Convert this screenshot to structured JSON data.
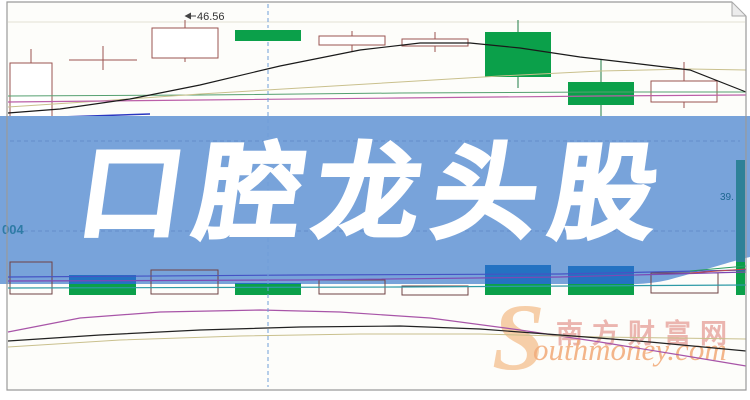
{
  "banner": {
    "title": "口腔龙头股"
  },
  "watermark": {
    "s": "S",
    "en_rest": "outhmoney.com",
    "cn": "南方财富网"
  },
  "colors": {
    "banner": "#78a3da",
    "candle_green": "#0ba04a",
    "candle_outline": "#9a5450",
    "green_wick": "#1f7d45",
    "vol_outline": "#6f4244",
    "cap_blue": "#2472c2",
    "ma_black": "#1a1a1a",
    "ma_khaki": "#c9c08d",
    "ma_green": "#55a070",
    "ma_magenta": "#bb5fa8",
    "ma_blue": "#2a36c0",
    "vol_blue": "#4553c4",
    "vol_purple": "#7d49b4",
    "vol_teal": "#2e9aa6",
    "seg_red": "#c44848",
    "seg_green": "#2a9e62",
    "low_magenta": "#a855a8",
    "low_black": "#222222",
    "low_khaki": "#c9c08d",
    "crosshair": "#6f9ed8",
    "grid_banner": "rgba(60,95,165,0.32)",
    "grid_top": "#e4e1d4",
    "price_label_color": "#333333",
    "left_label_color": "#2e7ba6",
    "right_label_color": "#1e6690"
  },
  "chart_data": {
    "type": "candlestick",
    "units": "pixels",
    "description": "Daily K-line chart with volume pane and indicator curves, overlaid by a blue headline banner; only one price value (46.56) is visible on screen.",
    "price_label": "46.56",
    "left_label": "004",
    "right_label": "39.",
    "crosshair": {
      "x": 268,
      "segments": [
        [
          4,
          28
        ],
        [
          42,
          387
        ]
      ]
    },
    "grid": {
      "top_y": 22,
      "banner_y": [
        141,
        231
      ]
    },
    "candles": [
      {
        "x": 10,
        "w": 42,
        "type": "hollow",
        "body": [
          63,
          127
        ],
        "wick": [
          49,
          133
        ]
      },
      {
        "x": 69,
        "w": 68,
        "type": "doji",
        "body": [
          60,
          60
        ],
        "wick": [
          46,
          70
        ]
      },
      {
        "x": 152,
        "w": 66,
        "type": "hollow",
        "body": [
          28,
          58
        ],
        "wick": [
          20,
          62
        ]
      },
      {
        "x": 235,
        "w": 66,
        "type": "green",
        "body": [
          30,
          41
        ],
        "wick": [
          30,
          41
        ]
      },
      {
        "x": 319,
        "w": 66,
        "type": "hollow",
        "body": [
          36,
          45
        ],
        "wick": [
          31,
          52
        ]
      },
      {
        "x": 402,
        "w": 66,
        "type": "hollow",
        "body": [
          39,
          46
        ],
        "wick": [
          32,
          52
        ]
      },
      {
        "x": 485,
        "w": 66,
        "type": "green",
        "body": [
          32,
          77
        ],
        "wick": [
          20,
          88
        ]
      },
      {
        "x": 568,
        "w": 66,
        "type": "green",
        "body": [
          82,
          105
        ],
        "wick": [
          60,
          125
        ]
      },
      {
        "x": 651,
        "w": 66,
        "type": "hollow",
        "body": [
          81,
          102
        ],
        "wick": [
          62,
          108
        ]
      }
    ],
    "volume_bars": [
      {
        "x": 10,
        "w": 42,
        "type": "hollow",
        "y": [
          262,
          294
        ]
      },
      {
        "x": 69,
        "w": 67,
        "type": "green",
        "y": [
          275,
          295
        ]
      },
      {
        "x": 151,
        "w": 67,
        "type": "hollow",
        "y": [
          270,
          294
        ]
      },
      {
        "x": 235,
        "w": 66,
        "type": "green",
        "y": [
          283,
          295
        ]
      },
      {
        "x": 319,
        "w": 66,
        "type": "hollow",
        "y": [
          280,
          294
        ]
      },
      {
        "x": 402,
        "w": 66,
        "type": "hollow",
        "y": [
          286,
          295
        ]
      },
      {
        "x": 485,
        "w": 66,
        "type": "green",
        "y": [
          265,
          295
        ]
      },
      {
        "x": 568,
        "w": 66,
        "type": "green",
        "y": [
          266,
          295
        ]
      },
      {
        "x": 651,
        "w": 67,
        "type": "hollow",
        "y": [
          273,
          293
        ]
      },
      {
        "x": 736,
        "w": 9,
        "type": "green",
        "y": [
          160,
          295
        ],
        "cap": "#2e8198",
        "cap_end": 262
      }
    ],
    "lines_top": {
      "black": [
        [
          8,
          113
        ],
        [
          60,
          109
        ],
        [
          130,
          99
        ],
        [
          200,
          85
        ],
        [
          280,
          66
        ],
        [
          360,
          50
        ],
        [
          420,
          43
        ],
        [
          470,
          43
        ],
        [
          520,
          48
        ],
        [
          580,
          57
        ],
        [
          640,
          64
        ],
        [
          690,
          70
        ],
        [
          746,
          92
        ]
      ],
      "khaki": [
        [
          8,
          107
        ],
        [
          100,
          101
        ],
        [
          200,
          94
        ],
        [
          300,
          88
        ],
        [
          400,
          82
        ],
        [
          500,
          76
        ],
        [
          600,
          71
        ],
        [
          690,
          69
        ],
        [
          746,
          70
        ]
      ],
      "green": [
        [
          8,
          96
        ],
        [
          200,
          95
        ],
        [
          400,
          93
        ],
        [
          600,
          92
        ],
        [
          746,
          92
        ]
      ],
      "magenta": [
        [
          8,
          102
        ],
        [
          200,
          100
        ],
        [
          400,
          98
        ],
        [
          600,
          96
        ],
        [
          746,
          95
        ]
      ],
      "blue": [
        [
          8,
          120
        ],
        [
          60,
          117
        ],
        [
          150,
          114
        ]
      ]
    },
    "lines_volume": {
      "blue": [
        [
          8,
          277
        ],
        [
          300,
          275
        ],
        [
          560,
          274
        ],
        [
          746,
          270
        ]
      ],
      "purple": [
        [
          8,
          281
        ],
        [
          300,
          280
        ],
        [
          560,
          277
        ],
        [
          746,
          272
        ]
      ],
      "teal": [
        [
          8,
          288
        ],
        [
          400,
          287
        ],
        [
          746,
          285
        ]
      ],
      "red_seg": [
        [
          690,
          273
        ],
        [
          746,
          269
        ]
      ],
      "green_seg": [
        [
          690,
          271
        ],
        [
          746,
          266
        ]
      ]
    },
    "lines_bottom": {
      "magenta": [
        [
          8,
          332
        ],
        [
          80,
          318
        ],
        [
          160,
          312
        ],
        [
          260,
          310
        ],
        [
          340,
          312
        ],
        [
          430,
          318
        ],
        [
          520,
          330
        ],
        [
          600,
          342
        ],
        [
          680,
          355
        ],
        [
          746,
          366
        ]
      ],
      "black": [
        [
          8,
          341
        ],
        [
          100,
          335
        ],
        [
          200,
          330
        ],
        [
          300,
          327
        ],
        [
          400,
          326
        ],
        [
          480,
          329
        ],
        [
          560,
          335
        ],
        [
          650,
          342
        ],
        [
          746,
          351
        ]
      ],
      "khaki": [
        [
          8,
          347
        ],
        [
          120,
          340
        ],
        [
          240,
          336
        ],
        [
          360,
          334
        ],
        [
          480,
          334
        ],
        [
          600,
          337
        ],
        [
          746,
          339
        ]
      ]
    }
  }
}
